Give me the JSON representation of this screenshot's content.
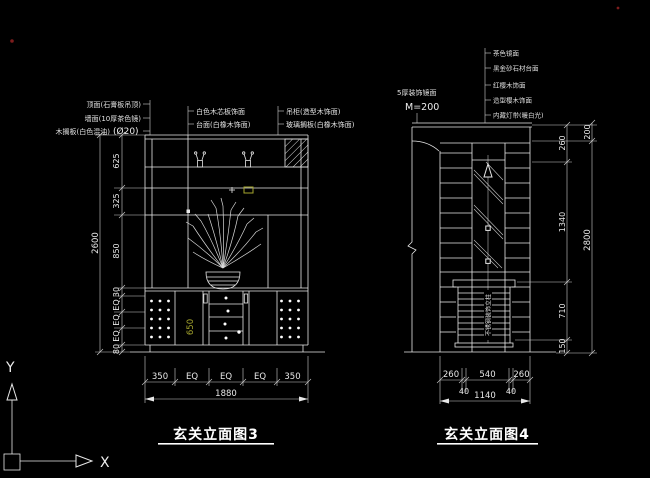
{
  "palette": {
    "background": "#000000",
    "line": "#e8e8e8",
    "dim_text": "#eeeeee",
    "accent_yellow": "#a6a62e",
    "red_marker": "#7d1d1d"
  },
  "ucs": {
    "x_label": "X",
    "y_label": "Y"
  },
  "left_drawing": {
    "title": "玄关立面图3",
    "callouts_left": [
      "顶面(石膏板吊顶)",
      "墙面(10厚茶色镜)",
      "木搁板(白色混油)"
    ],
    "callout_dia": "(Ø20)",
    "callouts_mid": [
      "白色木芯板饰面",
      "台面(白橡木饰面)"
    ],
    "callouts_right": [
      "吊柜(造型木饰面)",
      "玻璃搁板(白橡木饰面)"
    ],
    "dim_total_height": "2600",
    "dims_height": [
      "625",
      "325",
      "850",
      "30",
      "EQ",
      "EQ",
      "EQ",
      "80"
    ],
    "dim_counter_height": "650",
    "dims_width": [
      "350",
      "EQ",
      "EQ",
      "EQ",
      "350"
    ],
    "dim_total_width": "1880"
  },
  "right_drawing": {
    "title": "玄关立面图4",
    "note": {
      "line1": "5厚装饰镜面",
      "line2": "M=200"
    },
    "callouts": [
      "茶色镜面",
      "黑金砂石材台面",
      "红樱木饰面",
      "造型樱木饰面",
      "内藏灯带(暖白光)"
    ],
    "center_label": "不锈钢装饰立柱",
    "dims_height": [
      "260",
      "1340",
      "710",
      "150"
    ],
    "dims_height_outer": [
      "200",
      "2800"
    ],
    "dims_width": [
      "260",
      "540",
      "260"
    ],
    "dims_width_small": [
      "40",
      "40"
    ],
    "dim_total_width": "1140"
  }
}
